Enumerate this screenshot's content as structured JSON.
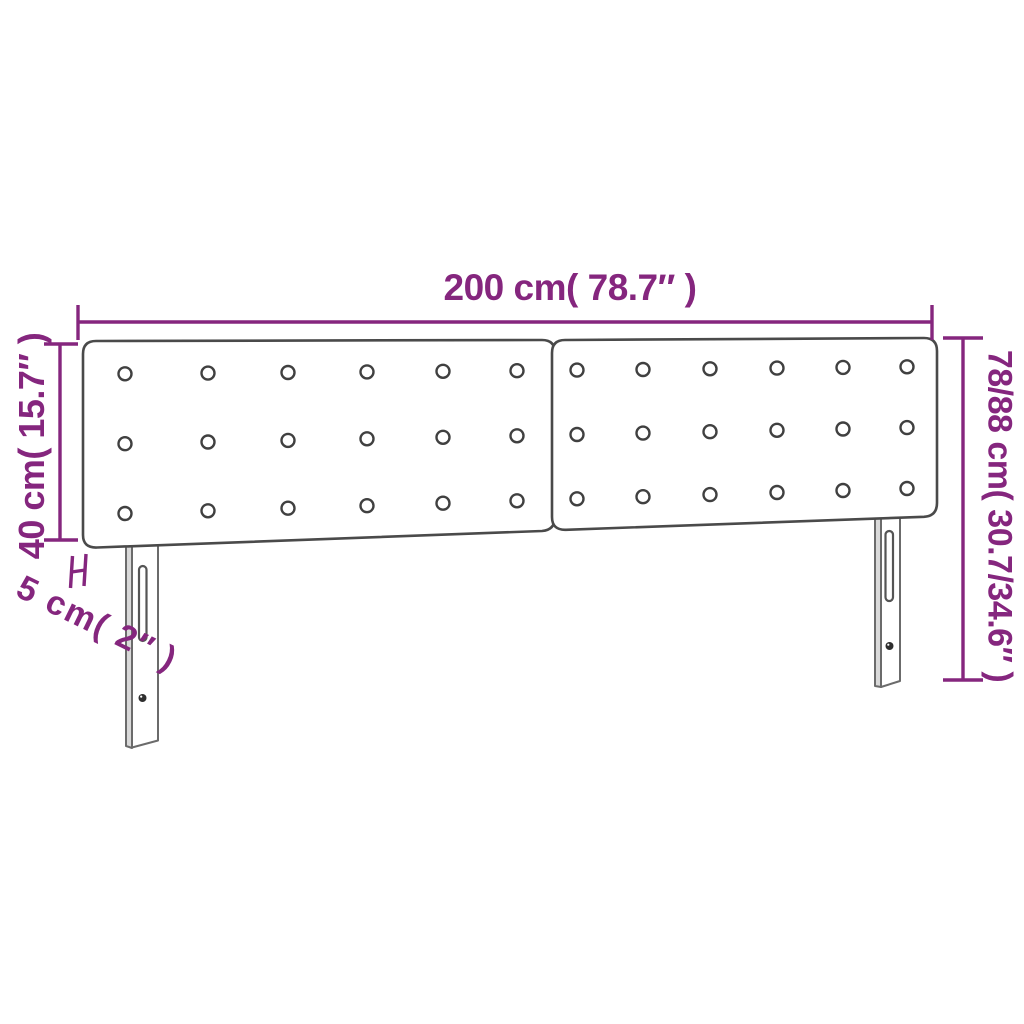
{
  "colors": {
    "accent": "#85267e",
    "line": "#4a4a4a",
    "leg_line": "#6b6b6b"
  },
  "dimensions": {
    "width_label": "200 cm( 78.7″ )",
    "total_height_label": "78/88 cm( 30.7/34.6″ )",
    "panel_height_label": "40 cm( 15.7″ )",
    "thickness_label": "5 cm( 2″ )"
  },
  "figure": {
    "type": "product-dimension-diagram",
    "subject": "upholstered headboard with two tufted panels and two legs",
    "panel_count": 2,
    "button_rows": 3,
    "button_cols_per_panel": 6,
    "leg_count": 2
  }
}
